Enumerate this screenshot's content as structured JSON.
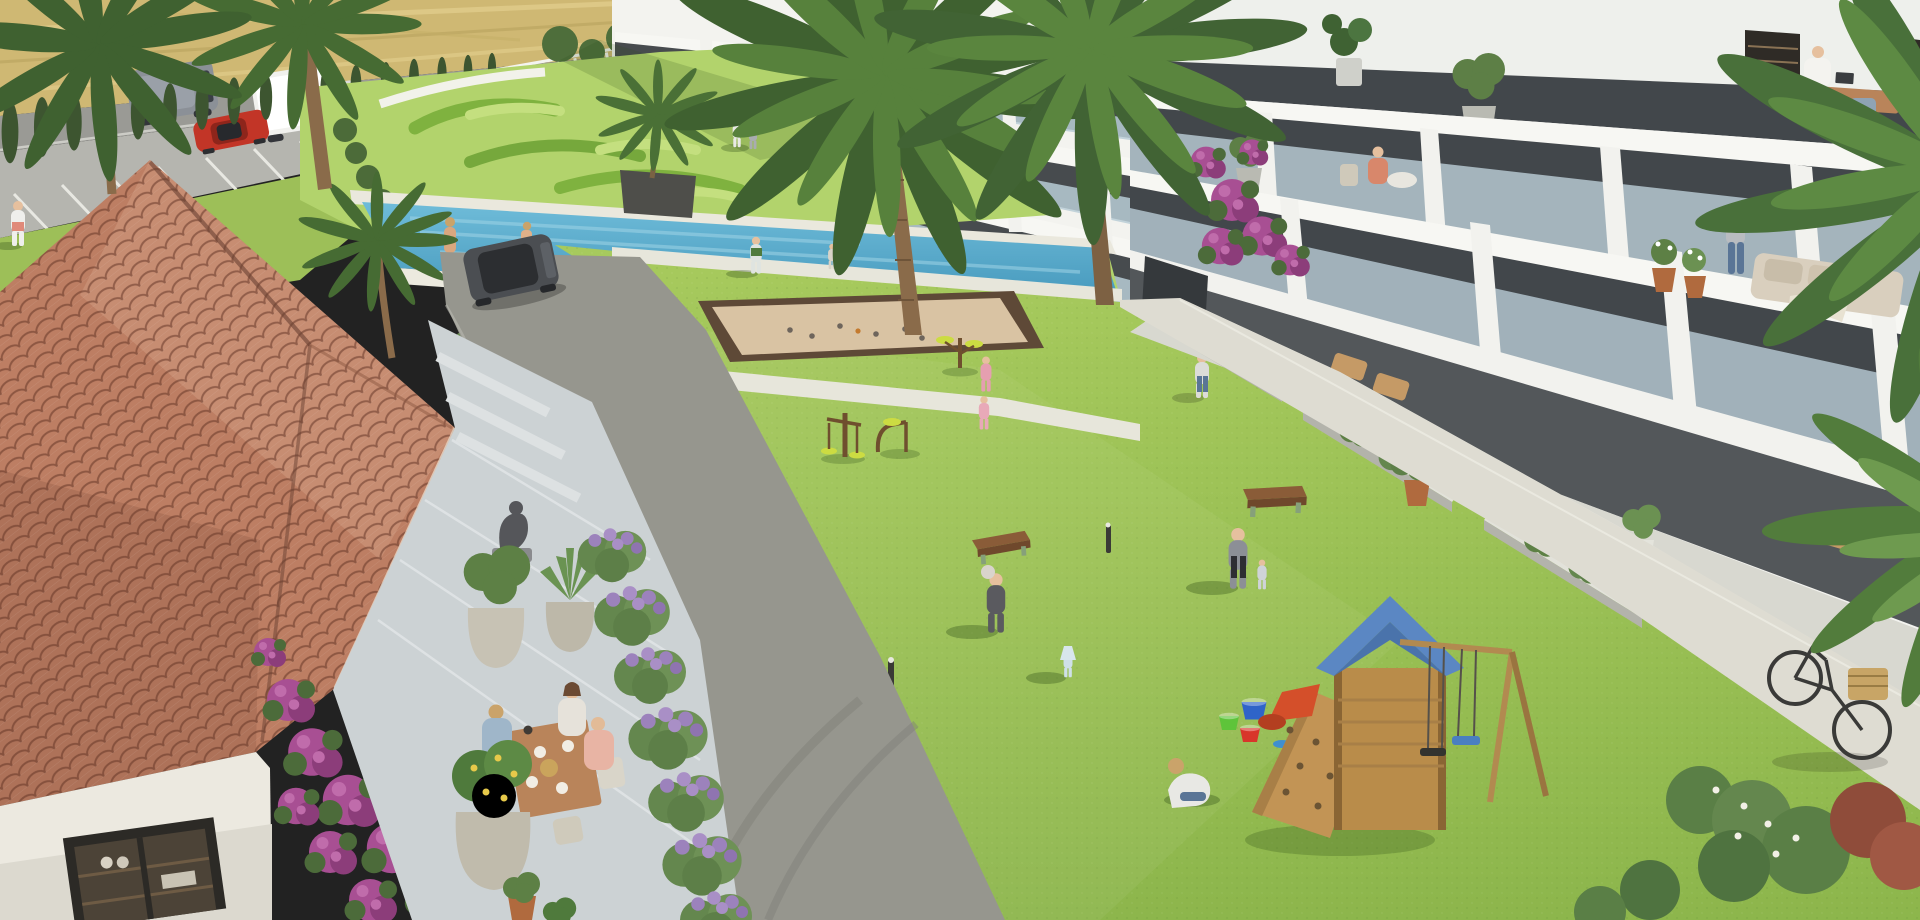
{
  "scene": {
    "title": "Aerial 3D rendering of a Mediterranean residential complex courtyard",
    "style": "architectural visualization",
    "time_of_day": "sunny midday",
    "visible_text": "none"
  },
  "palette": {
    "field": "#cfb873",
    "field_light": "#e2cf8e",
    "road": "#9a9a95",
    "parking": "#b5b5af",
    "asphalt": "#96968e",
    "concrete_path": "#dedcd2",
    "walkway": "#e7e6db",
    "lawn": "#9cc253",
    "lawn_bright": "#aed168",
    "garden_lawn": "#b2d36c",
    "hedge_dark": "#78aa3e",
    "pool_water": "#58acce",
    "pool_deep": "#3e92b7",
    "pool_deck": "#eae8dd",
    "roof_tile": "#bd7e63",
    "roof_tile_light": "#d8a68c",
    "roof_tile_dark": "#8e5a44",
    "stucco": "#ece9e0",
    "facade": "#f3f3ef",
    "facade_shade": "#dadcd8",
    "glass": "#b9ccd6",
    "window_dark": "#3e4347",
    "slab_shadow": "#6a6e66",
    "cypress": "#3d5530",
    "palm": "#4a7036",
    "palm_light": "#5f8c43",
    "shrub": "#5f8348",
    "lavender": "#9c82bc",
    "bougainvillea": "#a84f93",
    "bougainvillea_dark": "#8c3d7a",
    "sand": "#d9c3a3",
    "sand_border": "#5e4937",
    "bench_wood": "#8a5c38",
    "gym_wood": "#6f4f2e",
    "gym_yellow": "#ccdc42",
    "play_wood": "#c29455",
    "play_roof": "#5b87c3",
    "slide_red": "#d44f2a",
    "swing_seat_blue": "#4a7fc1",
    "bucket_green": "#5ec43a",
    "bucket_blue": "#2f64c8",
    "bucket_red": "#d8362a",
    "bike_frame": "#3a3a38",
    "bike_basket": "#c8a566",
    "car_red": "#c23527",
    "van_grey": "#8b9097",
    "truck_white": "#f1f1ee",
    "suv_grey": "#4b4e52",
    "skin": "#e6c09e",
    "terrace_tile": "#ccd2d4",
    "table_wood": "#b9845a",
    "statue_grey": "#55565a",
    "planter_grey": "#c7c2b4",
    "terracotta": "#b06a3e"
  },
  "inventory": {
    "buildings": [
      {
        "id": "clubhouse",
        "desc": "single-storey clubhouse with terracotta tiled hip roof, white stucco walls, bougainvillea and cafe terrace"
      },
      {
        "id": "apartment-block",
        "desc": "modern white multi-storey apartment building with continuous glass-fronted balconies receding to the right"
      }
    ],
    "amenities": [
      "lap swimming pool with island planter",
      "petanque sand court",
      "outdoor gym machines",
      "children playground with slide, climbing wall and swings",
      "large central lawn",
      "cafe terrace with dining table",
      "topiary garden",
      "roadside parking"
    ],
    "vehicles": [
      {
        "id": "grey-van",
        "location": "road, top left"
      },
      {
        "id": "white-box-truck",
        "location": "road, top left"
      },
      {
        "id": "red-car",
        "location": "parking bays, top left"
      },
      {
        "id": "dark-suv",
        "location": "internal drive beside clubhouse"
      },
      {
        "id": "bicycle-with-basket",
        "location": "leaning at footpath, bottom right"
      }
    ],
    "people": [
      {
        "id": "walker",
        "desc": "person strolling on grass verge",
        "at": "far left"
      },
      {
        "id": "swimmers",
        "desc": "two people at the pool edge",
        "at": "pool"
      },
      {
        "id": "couple-walking",
        "desc": "two residents on upper walkway",
        "at": "centre top"
      },
      {
        "id": "boy-playing",
        "desc": "boy playing ball",
        "at": "upper lawn"
      },
      {
        "id": "toddler",
        "desc": "toddler on upper lawn",
        "at": "upper lawn"
      },
      {
        "id": "two-girls-gym",
        "desc": "two girls in pink at the outdoor gym",
        "at": "gym"
      },
      {
        "id": "mother-with-baby",
        "desc": "mother carrying baby",
        "at": "central lawn"
      },
      {
        "id": "toddler-in-dress",
        "desc": "toddler in pale blue dress",
        "at": "central lawn"
      },
      {
        "id": "parent-with-child",
        "desc": "parent in grey hoodie with small child",
        "at": "central lawn"
      },
      {
        "id": "crouching-boy",
        "desc": "boy crouching playing with toys",
        "at": "near playground"
      },
      {
        "id": "path-walker",
        "desc": "woman walking on concrete path",
        "at": "right path"
      },
      {
        "id": "cafe-guests",
        "desc": "three people having breakfast at cafe table",
        "at": "cafe terrace"
      },
      {
        "id": "man-at-desk",
        "desc": "man working at a desk on top balcony",
        "at": "apartment balcony"
      },
      {
        "id": "woman-on-balcony",
        "desc": "woman seated at balcony table",
        "at": "apartment balcony"
      },
      {
        "id": "plant-waterer",
        "desc": "resident tending balcony plants",
        "at": "apartment balcony"
      }
    ],
    "play_items": [
      {
        "id": "buckets",
        "desc": "green, blue and red toy buckets on the grass"
      },
      {
        "id": "benches",
        "desc": "two wooden benches on the lawn"
      },
      {
        "id": "petanque-balls",
        "desc": "boules scattered on the sand court"
      }
    ],
    "vegetation": [
      "tall palm trees",
      "cypress hedgerow along road",
      "lavender borders",
      "magenta bougainvillea",
      "potted olive trees",
      "agave",
      "clipped topiary swirls",
      "flowering shrubs"
    ]
  }
}
